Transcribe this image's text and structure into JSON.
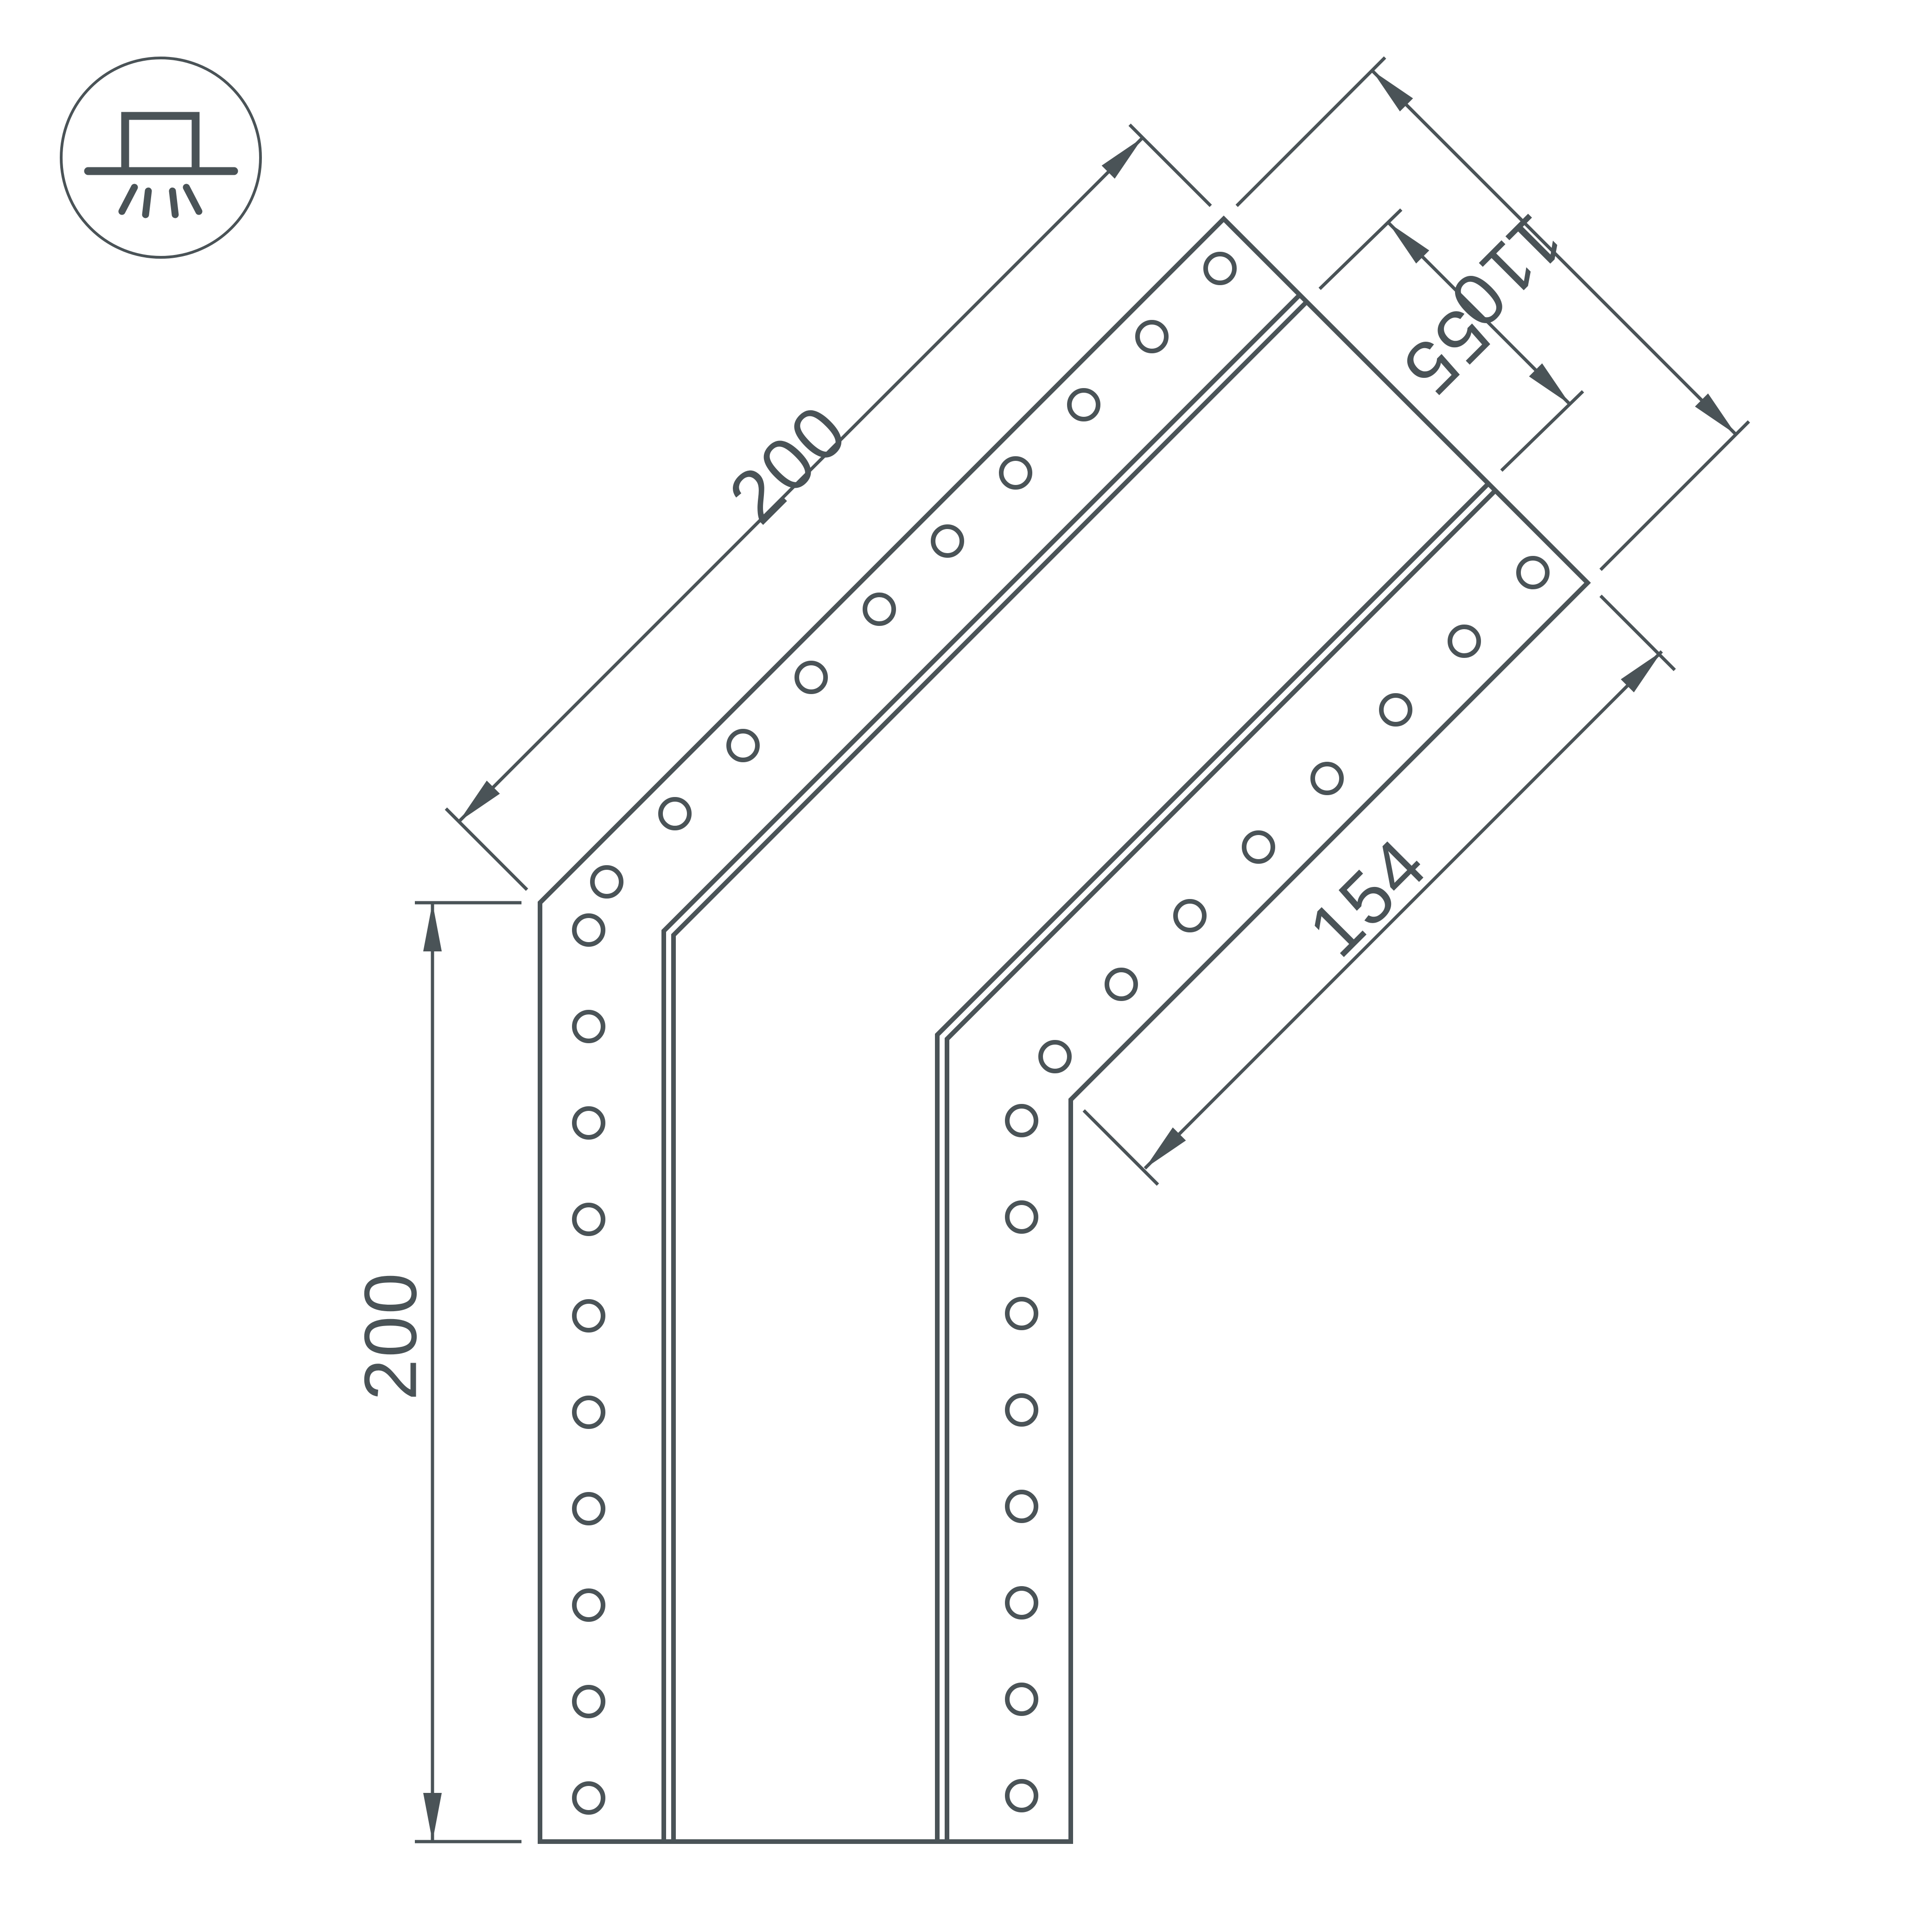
{
  "drawing": {
    "kind": "technical-dimension-drawing",
    "background_color": "#ffffff",
    "line_color": "#4a5357"
  },
  "icon": {
    "name": "surface-mounted-light-icon"
  },
  "dimensions": {
    "left_height": "200",
    "upper_arm_length": "200",
    "end_width": "110",
    "channel_width": "55",
    "lower_arm_length": "154"
  }
}
